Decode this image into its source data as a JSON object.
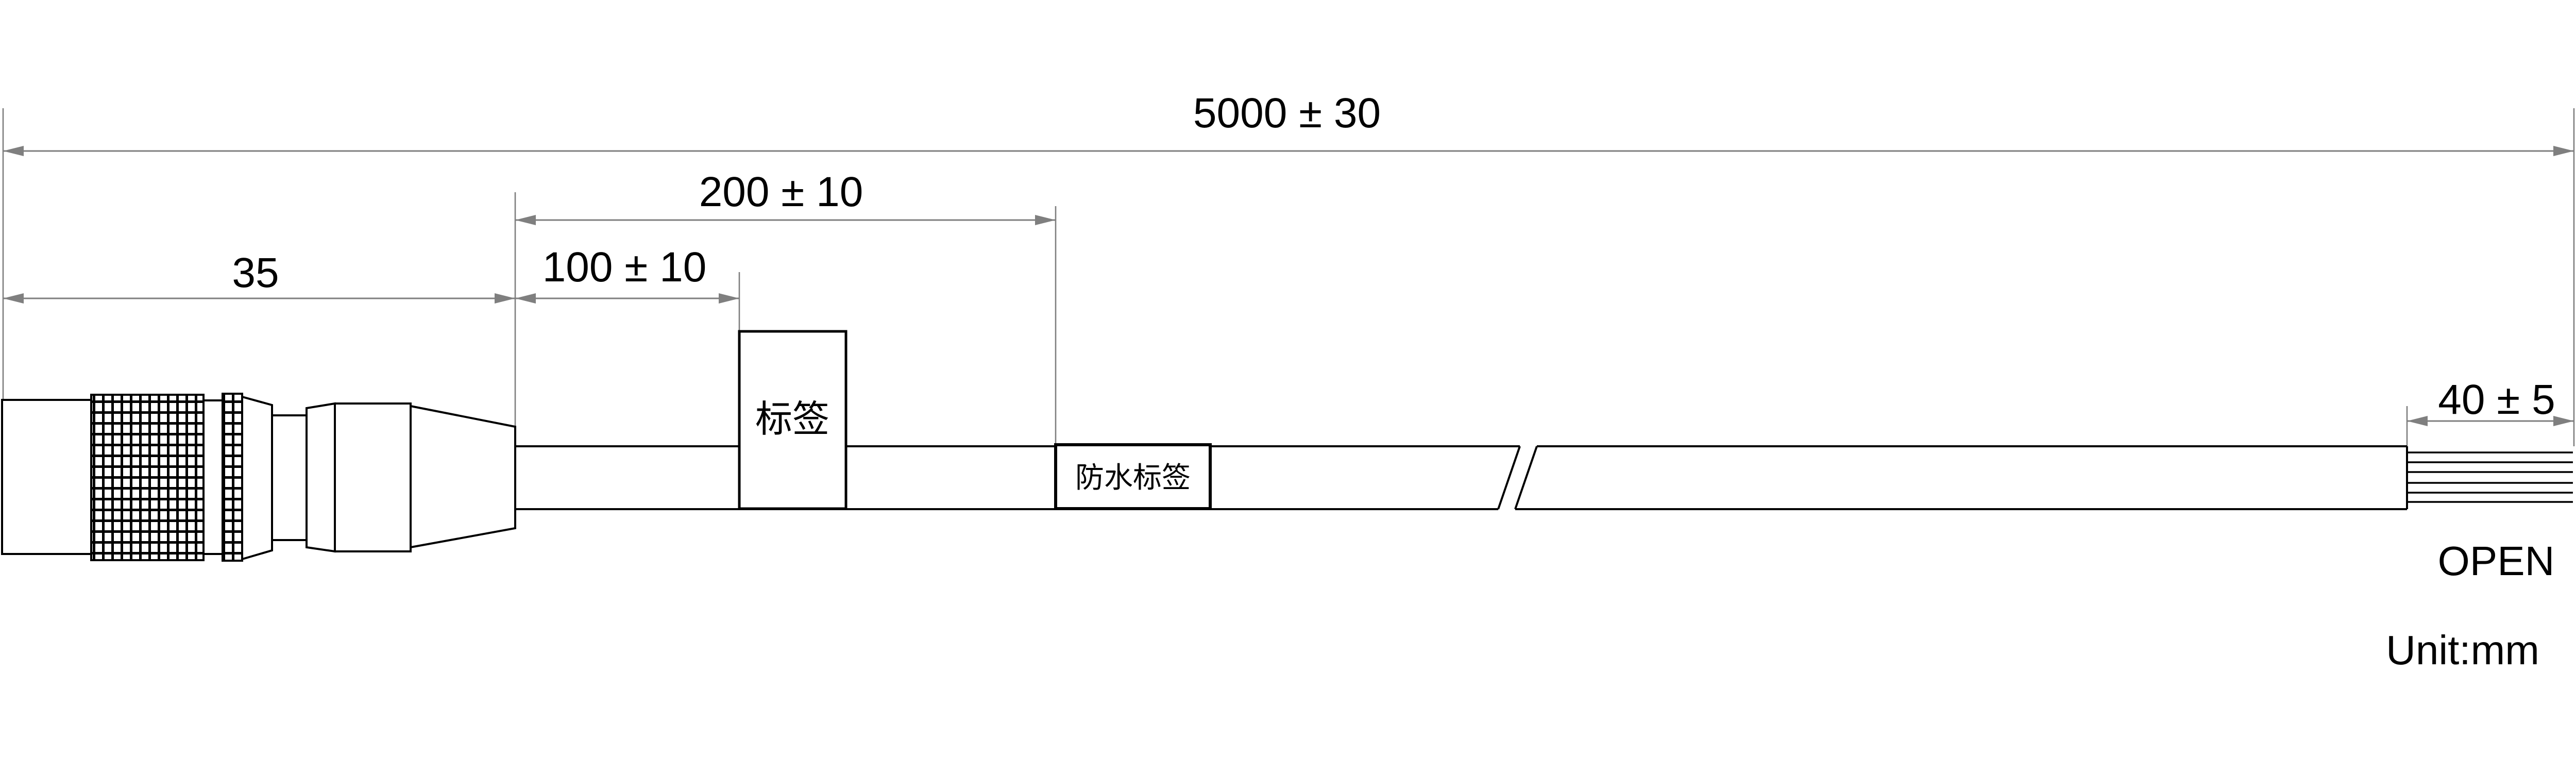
{
  "drawing": {
    "dimensions": {
      "overall_length": "5000 ± 30",
      "waterproof_label_position": "200 ± 10",
      "label_position": "100 ± 10",
      "connector_length": "35",
      "strip_length": "40 ± 5"
    },
    "labels": {
      "tag": "标签",
      "waterproof_tag": "防水标签",
      "wire_end": "OPEN",
      "unit_note": "Unit:mm"
    },
    "colors": {
      "outline": "#000000",
      "dimension_line": "#7f7f7f",
      "background": "#ffffff"
    }
  }
}
